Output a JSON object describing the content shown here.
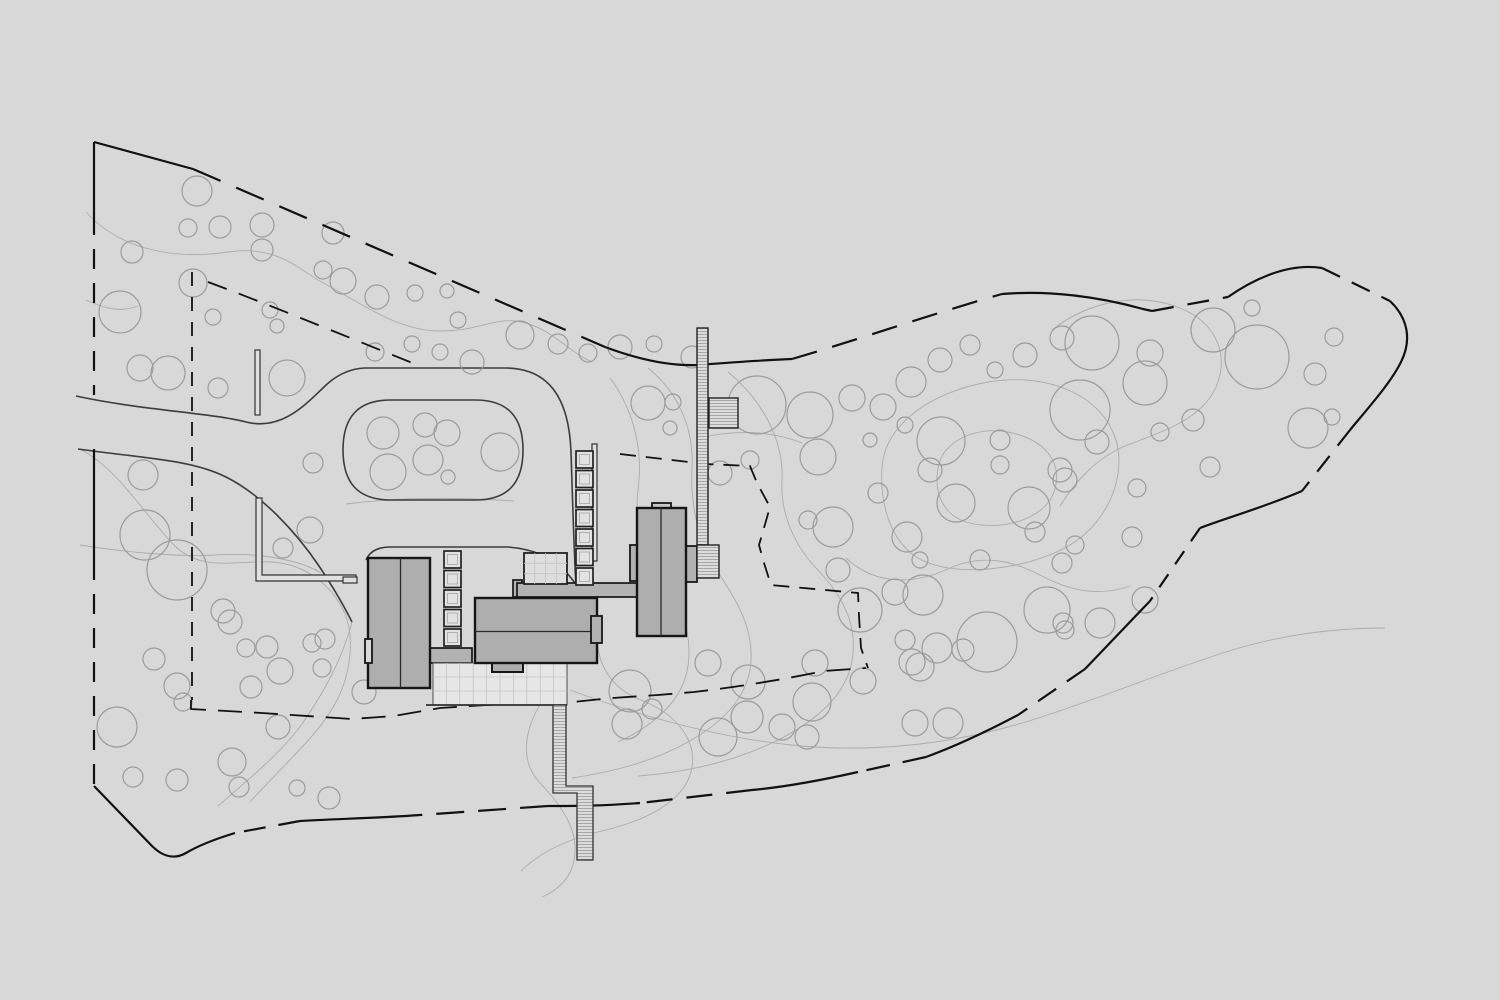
{
  "canvas": {
    "width": 1500,
    "height": 1000,
    "background": "#d8d8d8"
  },
  "palette": {
    "building_fill": "#aeaeae",
    "building_stroke": "#161616",
    "divider_stroke": "#2a2a2a",
    "walk_fill": "#b2b2b2",
    "terrace_fill": "#e6e6e6",
    "grid_line": "#c3c3c3",
    "trellis_fill": "#e2e2e2",
    "trellis_stroke": "#222222",
    "inner_square_stroke": "#b0b0b0",
    "tree_stroke": "#9b9b9b",
    "contour_stroke": "#ababab",
    "road_stroke": "#3c3c3c",
    "boundary_stroke": "#111111",
    "hatch_fill": "#dcdcdc",
    "hatch_line": "#9a9a9a",
    "wall_fill": "#e0e0e0",
    "wall_stroke": "#333333",
    "terrace_edge_stroke": "#2f2f2f"
  },
  "site_plan": {
    "trees": [
      [
        197,
        191,
        15
      ],
      [
        188,
        228,
        9
      ],
      [
        220,
        227,
        11
      ],
      [
        262,
        225,
        12
      ],
      [
        262,
        250,
        11
      ],
      [
        132,
        252,
        11
      ],
      [
        193,
        283,
        14
      ],
      [
        120,
        312,
        21
      ],
      [
        213,
        317,
        8
      ],
      [
        270,
        310,
        8
      ],
      [
        277,
        326,
        7
      ],
      [
        323,
        270,
        9
      ],
      [
        343,
        281,
        13
      ],
      [
        377,
        297,
        12
      ],
      [
        415,
        293,
        8
      ],
      [
        447,
        291,
        7
      ],
      [
        458,
        320,
        8
      ],
      [
        168,
        373,
        17
      ],
      [
        218,
        388,
        10
      ],
      [
        287,
        378,
        18
      ],
      [
        140,
        368,
        13
      ],
      [
        333,
        233,
        11
      ],
      [
        375,
        352,
        9
      ],
      [
        412,
        344,
        8
      ],
      [
        440,
        352,
        8
      ],
      [
        472,
        362,
        12
      ],
      [
        520,
        335,
        14
      ],
      [
        558,
        344,
        10
      ],
      [
        588,
        353,
        9
      ],
      [
        620,
        347,
        12
      ],
      [
        654,
        344,
        8
      ],
      [
        692,
        357,
        11
      ],
      [
        383,
        433,
        16
      ],
      [
        425,
        425,
        12
      ],
      [
        447,
        433,
        13
      ],
      [
        500,
        452,
        19
      ],
      [
        428,
        460,
        15
      ],
      [
        388,
        472,
        18
      ],
      [
        448,
        477,
        7
      ],
      [
        313,
        463,
        10
      ],
      [
        310,
        530,
        13
      ],
      [
        283,
        548,
        10
      ],
      [
        143,
        475,
        15
      ],
      [
        145,
        535,
        25
      ],
      [
        177,
        570,
        30
      ],
      [
        117,
        727,
        20
      ],
      [
        223,
        611,
        12
      ],
      [
        230,
        622,
        12
      ],
      [
        246,
        648,
        9
      ],
      [
        267,
        647,
        11
      ],
      [
        280,
        671,
        13
      ],
      [
        251,
        687,
        11
      ],
      [
        154,
        659,
        11
      ],
      [
        177,
        686,
        13
      ],
      [
        183,
        702,
        9
      ],
      [
        133,
        777,
        10
      ],
      [
        177,
        780,
        11
      ],
      [
        232,
        762,
        14
      ],
      [
        239,
        787,
        10
      ],
      [
        297,
        788,
        8
      ],
      [
        329,
        798,
        11
      ],
      [
        325,
        639,
        10
      ],
      [
        322,
        668,
        9
      ],
      [
        278,
        727,
        12
      ],
      [
        312,
        643,
        9
      ],
      [
        364,
        692,
        12
      ],
      [
        708,
        663,
        13
      ],
      [
        748,
        682,
        17
      ],
      [
        815,
        663,
        13
      ],
      [
        812,
        702,
        19
      ],
      [
        747,
        717,
        16
      ],
      [
        782,
        727,
        13
      ],
      [
        807,
        737,
        12
      ],
      [
        630,
        691,
        21
      ],
      [
        652,
        709,
        10
      ],
      [
        718,
        737,
        19
      ],
      [
        627,
        724,
        15
      ],
      [
        863,
        681,
        13
      ],
      [
        912,
        662,
        13
      ],
      [
        963,
        650,
        11
      ],
      [
        923,
        595,
        20
      ],
      [
        895,
        592,
        13
      ],
      [
        987,
        642,
        30
      ],
      [
        1047,
        610,
        23
      ],
      [
        1065,
        630,
        9
      ],
      [
        937,
        648,
        15
      ],
      [
        920,
        667,
        14
      ],
      [
        915,
        723,
        13
      ],
      [
        948,
        723,
        15
      ],
      [
        1145,
        600,
        13
      ],
      [
        838,
        570,
        12
      ],
      [
        648,
        403,
        17
      ],
      [
        673,
        402,
        8
      ],
      [
        670,
        428,
        7
      ],
      [
        757,
        405,
        29
      ],
      [
        810,
        415,
        23
      ],
      [
        852,
        398,
        13
      ],
      [
        883,
        407,
        13
      ],
      [
        818,
        457,
        18
      ],
      [
        720,
        473,
        12
      ],
      [
        750,
        460,
        9
      ],
      [
        808,
        520,
        9
      ],
      [
        833,
        527,
        20
      ],
      [
        907,
        537,
        15
      ],
      [
        878,
        493,
        10
      ],
      [
        911,
        382,
        15
      ],
      [
        940,
        360,
        12
      ],
      [
        970,
        345,
        10
      ],
      [
        995,
        370,
        8
      ],
      [
        1025,
        355,
        12
      ],
      [
        905,
        425,
        8
      ],
      [
        870,
        440,
        7
      ],
      [
        941,
        441,
        24
      ],
      [
        1000,
        465,
        9
      ],
      [
        956,
        503,
        19
      ],
      [
        1029,
        508,
        21
      ],
      [
        1035,
        532,
        10
      ],
      [
        930,
        470,
        12
      ],
      [
        1000,
        440,
        10
      ],
      [
        1060,
        470,
        12
      ],
      [
        980,
        560,
        10
      ],
      [
        920,
        560,
        8
      ],
      [
        1075,
        545,
        9
      ],
      [
        860,
        610,
        22
      ],
      [
        905,
        640,
        10
      ],
      [
        1213,
        330,
        22
      ],
      [
        1257,
        357,
        32
      ],
      [
        1252,
        308,
        8
      ],
      [
        1334,
        337,
        9
      ],
      [
        1315,
        374,
        11
      ],
      [
        1308,
        428,
        20
      ],
      [
        1332,
        417,
        8
      ],
      [
        1150,
        353,
        13
      ],
      [
        1092,
        343,
        27
      ],
      [
        1062,
        338,
        12
      ],
      [
        1145,
        383,
        22
      ],
      [
        1080,
        410,
        30
      ],
      [
        1097,
        442,
        12
      ],
      [
        1160,
        432,
        9
      ],
      [
        1193,
        420,
        11
      ],
      [
        1210,
        467,
        10
      ],
      [
        1137,
        488,
        9
      ],
      [
        1065,
        480,
        12
      ],
      [
        1132,
        537,
        10
      ],
      [
        1062,
        563,
        10
      ],
      [
        1100,
        623,
        15
      ],
      [
        1063,
        623,
        10
      ]
    ],
    "contours": [
      "M86,212 C120,250 175,260 228,252 C275,245 298,268 318,280 C360,302 395,330 438,331 C478,332 495,316 522,322 C552,329 566,350 592,362",
      "M80,449 C120,470 148,520 176,547 C202,572 240,560 272,562 C304,564 332,584 345,614 C354,636 352,672 336,702 C318,736 282,766 250,802",
      "M80,545 C130,553 182,557 216,555 C258,552 300,560 321,573",
      "M648,368 C678,392 694,428 692,468 C690,508 700,544 716,569 C736,600 753,626 751,661 C749,696 724,722 688,742 C652,762 612,772 572,778",
      "M610,378 C636,413 643,455 638,490 C634,520 644,550 659,572 C679,601 693,631 688,666 C683,701 653,726 618,742",
      "M728,372 C762,400 784,440 782,480 C780,515 796,548 818,570 C844,598 858,626 852,661 C846,696 814,723 772,743 C727,764 678,773 638,776",
      "M846,558 C878,588 918,583 950,568 C982,554 1012,560 1042,576 C1072,592 1102,596 1130,586",
      "M570,690 C640,716 722,739 802,746 C882,753 962,742 1032,720 C1102,698 1162,672 1232,650 C1282,635 1332,628 1385,628",
      "M527,618 C560,640 558,678 543,700 C523,730 520,762 540,783 C562,806 580,832 574,860 C571,878 558,890 542,897",
      "M601,614 C589,655 608,688 641,700 C677,714 699,742 691,772 C683,802 646,820 606,830 C571,838 541,851 521,871",
      "M352,622 C342,660 324,692 302,724 C282,752 248,780 218,806",
      "M346,504 C400,497 455,497 514,501",
      "M882,468 C884,424 932,392 988,382 C1044,373 1094,392 1112,430 C1130,466 1112,520 1070,545 C1028,570 950,580 915,556 C888,537 880,500 882,468 Z",
      "M938,468 C942,442 974,426 1008,432 C1044,439 1064,462 1054,492 C1044,520 1000,532 966,522 C942,514 934,492 938,468 Z",
      "M1052,330 C1090,300 1140,292 1180,308 C1215,322 1228,352 1218,382 C1205,420 1160,432 1125,446 C1095,459 1075,482 1060,506",
      "M86,300 C108,310 122,312 138,306",
      "M700,438 C736,429 772,431 802,443"
    ],
    "driveway": {
      "edges": [
        "M76,396 C140,410 212,413 246,422 C282,431 306,404 324,387 C336,375 349,369 364,368 L505,368",
        "M505,368 C549,368 569,398 571,452 C573,512 574,552 576,586",
        "M78,449 C150,459 192,460 226,477 C262,495 296,532 319,566 C335,590 344,606 352,622",
        "M366,560 C370,551 378,547 390,547 L508,547 C532,549 550,556 563,569 C569,575 573,580 577,586"
      ],
      "island": "M391,400 L475,400 C508,400 523,417 523,450 C523,483 508,500 475,500 L391,500 C358,500 343,483 343,450 C343,417 358,400 391,400 Z"
    },
    "boundary": {
      "solid": [
        "M94,142 L193,169",
        "M605,347 C640,360 672,366 697,365 C725,363 762,360 792,359",
        "M1002,294 C1050,290 1100,297 1143,309 L1152,311",
        "M1228,297 C1248,283 1285,262 1322,268",
        "M1390,301 C1408,318 1412,340 1401,362 C1390,384 1368,408 1350,430",
        "M1302,491 C1262,508 1226,518 1200,528",
        "M1150,601 L1085,669",
        "M1018,715 C982,734 948,749 926,757",
        "M858,772 C818,781 785,787 752,790",
        "M640,803 C600,806 574,806 548,806",
        "M420,815 C380,818 332,819 300,821",
        "M235,833 C212,840 196,847 186,853 C172,861 160,854 152,846 L94,786",
        "M94,142 L94,215",
        "M94,449 L94,560"
      ],
      "dashed": [
        {
          "d": "M193,169 L605,347",
          "dash": "30 17"
        },
        {
          "d": "M792,359 C860,339 935,313 1002,294",
          "dash": "26 16"
        },
        {
          "d": "M1152,311 L1228,297",
          "dash": "22 14"
        },
        {
          "d": "M1322,268 L1390,301",
          "dash": "20 13"
        },
        {
          "d": "M1350,430 L1302,491",
          "dash": "20 13"
        },
        {
          "d": "M1200,528 L1150,601",
          "dash": "16 12"
        },
        {
          "d": "M1085,669 L1018,715",
          "dash": "22 13"
        },
        {
          "d": "M926,757 L858,772",
          "dash": "24 13"
        },
        {
          "d": "M752,790 L640,803",
          "dash": "26 14"
        },
        {
          "d": "M548,806 L420,815",
          "dash": "28 14"
        },
        {
          "d": "M300,821 L235,833",
          "dash": "22 13"
        },
        {
          "d": "M94,215 L94,395",
          "dash": "20 14"
        },
        {
          "d": "M94,560 L94,786",
          "dash": "20 14"
        }
      ]
    },
    "inner_lines": [
      {
        "d": "M192,272 L192,700",
        "dash": "14 11"
      },
      {
        "d": "M208,282 C265,303 340,334 420,366",
        "dash": "20 13"
      },
      {
        "d": "M191,700 L191,709 L262,713 L352,719 L394,716 L440,708 L487,705 L563,703 L612,698 L658,695 L694,692 C738,687 786,679 824,671 L866,668",
        "dash": "24 12"
      },
      {
        "d": "M620,454 L706,464 L750,466 L757,483 L770,507 L759,545 L764,563 L771,585 L858,593 L859,616 L861,648 L868,668",
        "dash": "16 10"
      }
    ],
    "walls": {
      "l_wall": "M256,498 L256,581 L356,581 L356,575 L262,575 L262,498 Z",
      "stick_nw": {
        "x": 255,
        "y": 350,
        "w": 5,
        "h": 65
      },
      "stick_e": {
        "x": 592,
        "y": 444,
        "w": 5,
        "h": 117
      },
      "bar_w": {
        "x": 343,
        "y": 577,
        "w": 14,
        "h": 6
      }
    },
    "connector": {
      "x": 430,
      "y": 648,
      "w": 42,
      "h": 15
    },
    "walk": {
      "cap": {
        "x": 513,
        "y": 580,
        "w": 9,
        "h": 17
      },
      "deck": {
        "x": 517,
        "y": 583,
        "w": 123,
        "h": 14
      }
    },
    "terrace": {
      "x": 433,
      "y": 663,
      "w": 134,
      "h": 42,
      "cols": 10,
      "rows": 3
    },
    "terrace_edge": {
      "x1": 426,
      "y1": 705,
      "x2": 567,
      "y2": 705
    },
    "entry_trellis": {
      "x": 524,
      "y": 553,
      "w": 43,
      "h": 31,
      "cols": 4,
      "rows": 3
    },
    "ladders": [
      {
        "x": 444,
        "y": 551,
        "count": 5,
        "size": 17,
        "step": 19.5
      },
      {
        "x": 576,
        "y": 451,
        "count": 7,
        "size": 17,
        "step": 19.5
      }
    ],
    "buildings": {
      "left": {
        "x": 368,
        "y": 558,
        "w": 62,
        "h": 130,
        "divider": "M400.5,558 L400.5,688",
        "notch": {
          "x": 365,
          "y": 639,
          "w": 7,
          "h": 24
        }
      },
      "main": {
        "x": 475,
        "y": 598,
        "w": 122,
        "h": 65,
        "divider": "M475,631.5 L597,631.5",
        "fireplace": {
          "x": 591,
          "y": 616,
          "w": 11,
          "h": 27
        },
        "notch": {
          "x": 492,
          "y": 662,
          "w": 31,
          "h": 10
        }
      },
      "right": {
        "x": 637,
        "y": 508,
        "w": 49,
        "h": 128,
        "divider": "M661,508 L661,636",
        "chimney": {
          "x": 652,
          "y": 503,
          "w": 19,
          "h": 11
        },
        "bump_left": {
          "x": 630,
          "y": 545,
          "w": 7,
          "h": 36
        },
        "bump_right": {
          "x": 686,
          "y": 546,
          "w": 11,
          "h": 36
        }
      }
    },
    "spine_wall": {
      "main": {
        "x": 697,
        "y": 328,
        "w": 11,
        "h": 217
      },
      "base": {
        "x": 697,
        "y": 545,
        "w": 22,
        "h": 33
      }
    },
    "pavilion": {
      "x": 709,
      "y": 398,
      "w": 29,
      "h": 30
    },
    "stairs": {
      "path": "M553,705 L566,705 L566,786 L593,786 L593,860 L577,860 L577,793 L553,793 Z"
    }
  }
}
